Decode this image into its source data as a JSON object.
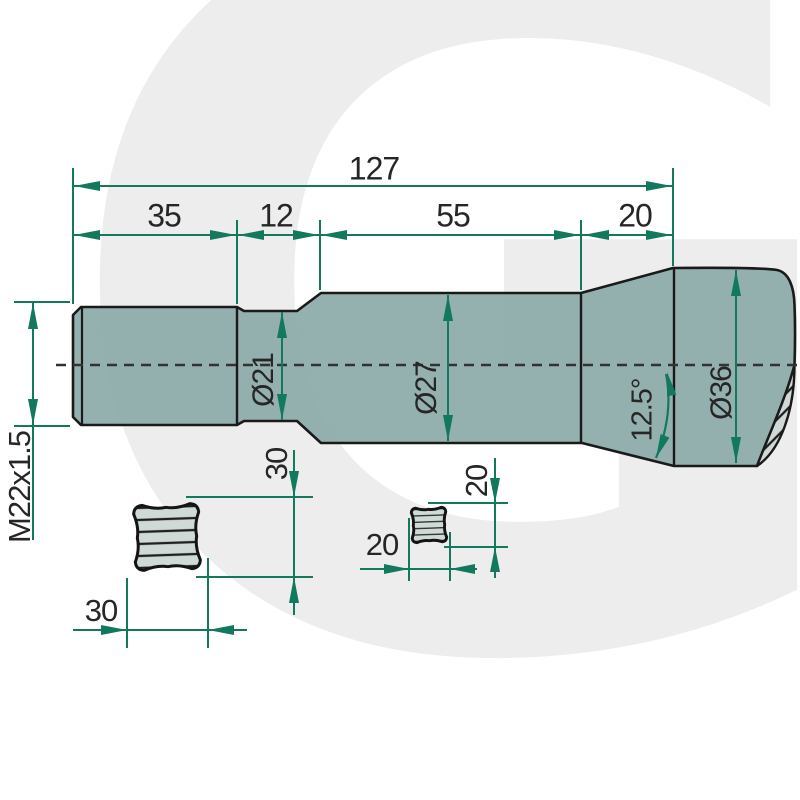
{
  "watermark": {
    "letter": "G"
  },
  "dims": {
    "total_length": "127",
    "seg_thread": "35",
    "seg_neck": "12",
    "seg_body": "55",
    "seg_cone": "20",
    "thread_spec": "M22x1.5",
    "dia_neck": "Ø21",
    "dia_body": "Ø27",
    "dia_end": "Ø36",
    "cone_angle": "12.5°",
    "section1_height": "30",
    "section1_width": "30",
    "section2_height": "20",
    "section2_width": "20"
  },
  "colors": {
    "dimension_green": "#13795e",
    "outline_black": "#1a1a1a",
    "body_fill": "#8caaa8",
    "section_fill": "#cfdad6",
    "watermark_gray": "#ededed",
    "centerline": "#333333"
  }
}
